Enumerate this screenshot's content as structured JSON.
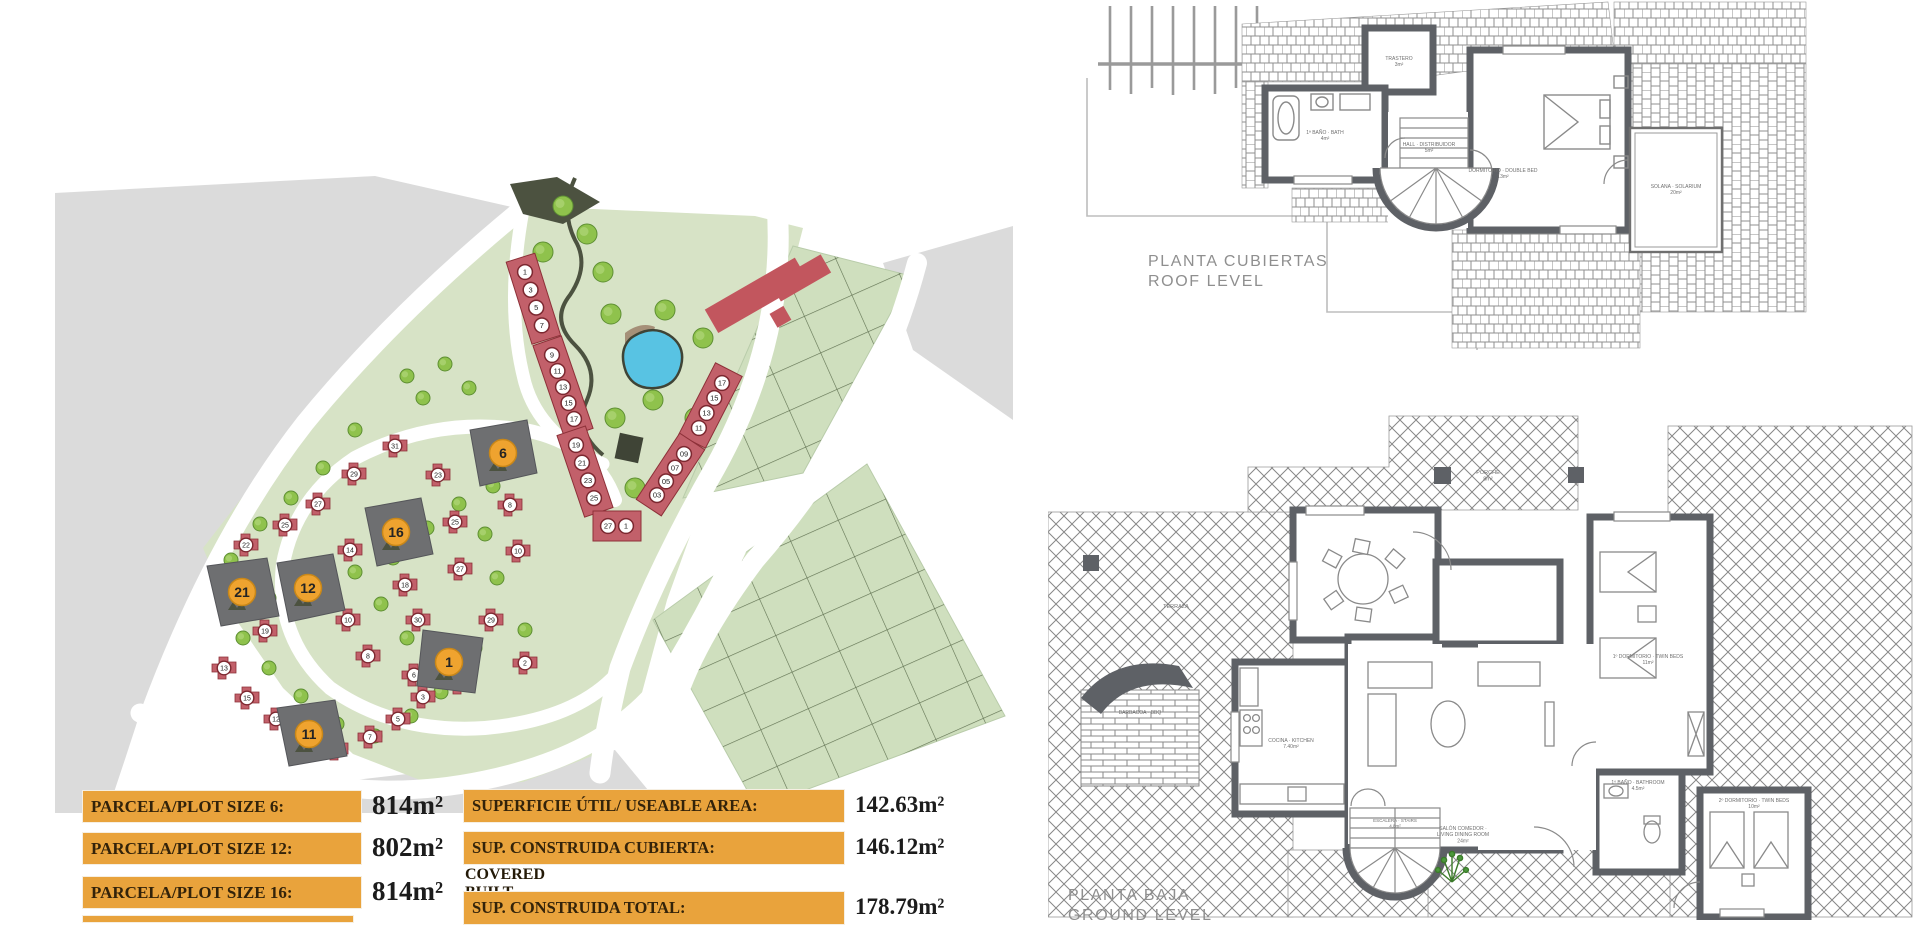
{
  "site_plan": {
    "featured_plots": [
      "6",
      "16",
      "12",
      "21",
      "11",
      "1"
    ],
    "townhouse_rows": [
      [
        "1",
        "3",
        "5",
        "7"
      ],
      [
        "9",
        "11",
        "13",
        "15",
        "17"
      ],
      [
        "19",
        "21",
        "23",
        "25"
      ],
      [
        "27",
        "1"
      ],
      [
        "17",
        "15",
        "13",
        "11"
      ],
      [
        "09",
        "07",
        "05",
        "03"
      ]
    ],
    "villa_plots": [
      "31",
      "29",
      "27",
      "25",
      "22",
      "19",
      "13",
      "15",
      "12",
      "9",
      "7",
      "5",
      "3",
      "23",
      "25",
      "27",
      "29",
      "30",
      "18",
      "14",
      "10",
      "8",
      "6",
      "4",
      "2",
      "8",
      "10"
    ]
  },
  "roof_plan": {
    "title_line1": "PLANTA CUBIERTAS",
    "title_line2": "ROOF LEVEL",
    "room_labels": [
      {
        "id": "store",
        "text": "TRASTERO|3m²"
      },
      {
        "id": "bath",
        "text": "1ª BAÑO · BATH|4m²"
      },
      {
        "id": "hall",
        "text": "HALL · DISTRIBUIDOR|5m²"
      },
      {
        "id": "bed",
        "text": "DORMITORIO · DOUBLE BED|13m²"
      },
      {
        "id": "terrace",
        "text": "SOLANA · SOLARIUM|20m²"
      }
    ]
  },
  "ground_plan": {
    "title_line1": "PLANTA BAJA",
    "title_line2": "GROUND LEVEL",
    "room_labels": [
      {
        "id": "terrace",
        "text": "TERRAZA"
      },
      {
        "id": "bbq",
        "text": "BARBACOA · BBQ"
      },
      {
        "id": "porch",
        "text": "PORCHE|8m²"
      },
      {
        "id": "kitchen",
        "text": "COCINA · KITCHEN|7.40m²"
      },
      {
        "id": "living",
        "text": "SALÓN COMEDOR ·|LIVING DINING ROOM|24m²"
      },
      {
        "id": "bed1",
        "text": "1º DORMITORIO · TWIN BEDS|11m²"
      },
      {
        "id": "bed2",
        "text": "2º DORMITORIO · TWIN BEDS|10m²"
      },
      {
        "id": "bath",
        "text": "1º BAÑO · BATHROOM|4.5m²"
      },
      {
        "id": "stairs",
        "text": "ESCALERA · STAIRS|4.8m²"
      }
    ]
  },
  "tables": {
    "plot_sizes": {
      "rows": [
        {
          "label": "PARCELA/PLOT SIZE 6:",
          "value": "814m²"
        },
        {
          "label": "PARCELA/PLOT SIZE 12:",
          "value": "802m²"
        },
        {
          "label": "PARCELA/PLOT SIZE 16:",
          "value": "814m²"
        }
      ],
      "partial_fourth_row": true
    },
    "areas": {
      "rows": [
        {
          "label": "SUPERFICIE ÚTIL/ USEABLE AREA:",
          "value": "142.63m²",
          "sublabel": ""
        },
        {
          "label": "SUP. CONSTRUIDA CUBIERTA:",
          "value": "146.12m²",
          "sublabel": "COVERED BUILT AREA"
        },
        {
          "label": "SUP. CONSTRUIDA TOTAL:",
          "value": "178.79m²",
          "sublabel": ""
        }
      ]
    }
  },
  "colors": {
    "accent_orange": "#E9A33C",
    "plot_gray": "#6E6F71",
    "house_red": "#C2606A",
    "green_light": "#D7E3C6",
    "pond_blue": "#58C3E3",
    "wall_gray": "#5E6166",
    "bg_gray": "#DBDBDB"
  }
}
